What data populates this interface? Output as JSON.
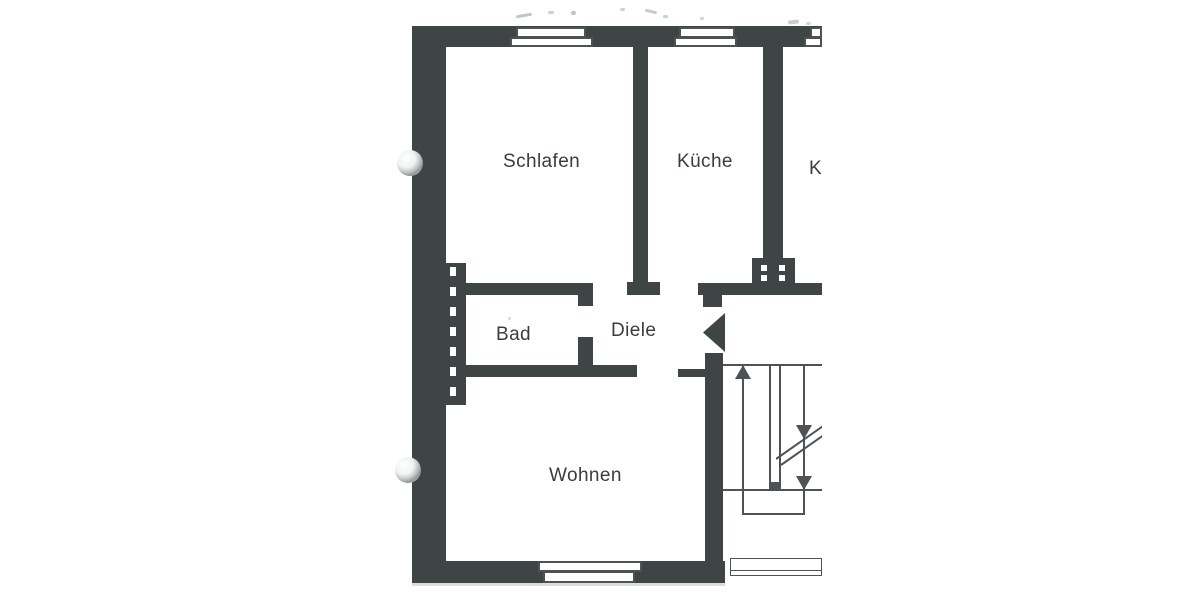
{
  "floor_plan": {
    "rooms": [
      {
        "id": "schlafen",
        "label": "Schlafen"
      },
      {
        "id": "kueche",
        "label": "Küche"
      },
      {
        "id": "k_cropped",
        "label": "K"
      },
      {
        "id": "bad",
        "label": "Bad"
      },
      {
        "id": "diele",
        "label": "Diele"
      },
      {
        "id": "wohnen",
        "label": "Wohnen"
      }
    ],
    "symbols": [
      {
        "name": "entry-door-swing-icon",
        "shape": "filled-triangle-pointing-left"
      },
      {
        "name": "stair-up-arrow-icon",
        "shape": "arrow-up"
      },
      {
        "name": "stair-down-arrow-icon",
        "shape": "arrow-down"
      },
      {
        "name": "window-icon",
        "shape": "double-white-rectangle-in-wall"
      },
      {
        "name": "installation-shaft-icon",
        "shape": "dark-strip-with-white-dashes"
      },
      {
        "name": "hole-punch-icon",
        "shape": "shaded-circle"
      }
    ],
    "colors": {
      "wall": "#3f4444",
      "line": "#4e5254",
      "paper": "#ffffff",
      "text": "#3a3d3d"
    }
  }
}
